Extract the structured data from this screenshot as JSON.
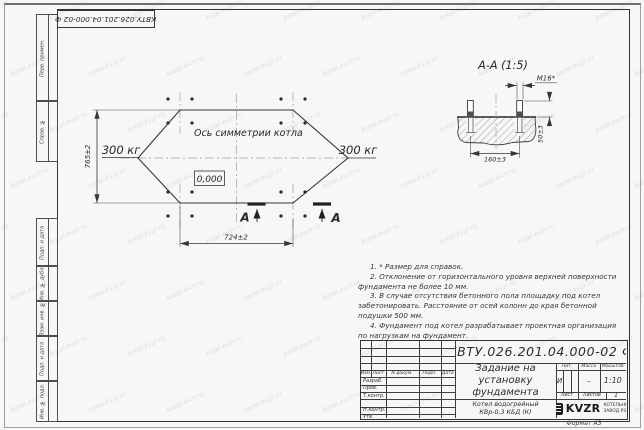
{
  "stamp_top": "КВТУ.026.201.04.000-02 Ф",
  "side_cells": [
    "Перв. примен.",
    "Справ. №",
    "Подп. и дата",
    "Инв. № дубл.",
    "Взам. инв. №",
    "Подп. и дата",
    "Инв. № подл."
  ],
  "plan": {
    "symmetry_label": "Ось симметрии котла",
    "load_left": "300 кг",
    "load_right": "300 кг",
    "elevation": "0,000",
    "width_dim": "724±2",
    "height_dim": "765±2",
    "section_letter": "А"
  },
  "section": {
    "title": "А-А  (1:5)",
    "thread_label": "М16*",
    "width_dim": "160±3",
    "height_dim": "50±3"
  },
  "notes": {
    "lines": [
      "1. * Размер для справок.",
      "2. Отклонение от горизонтального уровня верхней поверхности фундамента не более 10 мм.",
      "3. В случае отсутствия бетонного пола площадку под котел забетонировать. Расстояние от осей колонн до края бетонной подушки 500 мм.",
      "4. Фундамент под котел разрабатывает проектная организация по нагрузкам на фундамент."
    ]
  },
  "title_block": {
    "designation": "КВТУ.026.201.04.000-02  Ф",
    "title_lines": [
      "Задание на",
      "установку",
      "фундамента"
    ],
    "product_lines": [
      "Котел водогрейный",
      "КВр-0,3 КБД (К)"
    ],
    "cols": [
      "Изм.",
      "Лист",
      "N докум.",
      "Подп.",
      "Дата"
    ],
    "rows": [
      "Разраб.",
      "Пров.",
      "Т.контр.",
      "Н.контр.",
      "Утв."
    ],
    "lit_label": "Лит.",
    "lit_value": "И",
    "mass_label": "Масса",
    "mass_value": "–",
    "scale_label": "Масштаб",
    "scale_value": "1:10",
    "sheet_label": "Лист",
    "sheets_label": "Листов",
    "sheets_value": "1",
    "logo_word": "KVZR",
    "company_lines": [
      "КОТЕЛЬНЫЙ",
      "ЗАВОД РЭП"
    ],
    "format": "Формат А3"
  },
  "watermark": "kotel-kvzr.ru",
  "colors": {
    "ink": "#2f3338",
    "centerline": "#9aa0a8",
    "paper": "#f7f7f5"
  }
}
